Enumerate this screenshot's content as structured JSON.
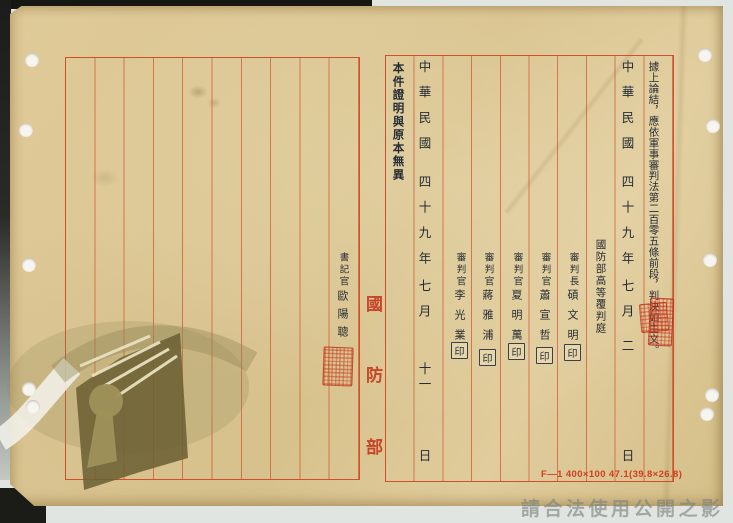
{
  "document": {
    "watermark_notice": "請合法使用公開之影像",
    "form_code": "F—1 400×100 47.1(39.8×26.8)",
    "fold_label": {
      "chars": [
        "國",
        "防",
        "部"
      ]
    },
    "right_page": {
      "verdict_line": "據上論結，應依軍事審判法第二百零五條前段，判決如主文。",
      "judgment_date": {
        "era": "中華民國",
        "year": "四十九年",
        "month": "七月",
        "day": "二",
        "day_suffix": "日"
      },
      "court": "國防部高等覆判庭",
      "officials": [
        {
          "role": "審判長",
          "name": "碩文明",
          "seal_glyph": "印"
        },
        {
          "role": "審判官",
          "name": "蕭宣哲",
          "seal_glyph": "印"
        },
        {
          "role": "審判官",
          "name": "夏明萬",
          "seal_glyph": "印"
        },
        {
          "role": "審判官",
          "name": "蔣雅浦",
          "seal_glyph": "印"
        },
        {
          "role": "審判官",
          "name": "李光業",
          "seal_glyph": "印"
        }
      ],
      "certification_statement": "本件證明與原本無異",
      "certification_date": {
        "era": "中華民國",
        "year": "四十九年",
        "month": "七月",
        "day": "十一",
        "day_suffix": "日"
      }
    },
    "left_page": {
      "clerk_role": "書記官",
      "clerk_name": "歐陽聰"
    },
    "icons": {
      "judgment_seal": "red-ink-seal",
      "clerk_seal": "red-ink-seal",
      "archives_emblem": "book-keyhole-watermark",
      "punch_hole": "binding-hole"
    },
    "colors": {
      "rule_red": "#cd4224",
      "seal_red": "#c5311d",
      "ink": "#242c35",
      "paper": "#dcc794",
      "fold_red": "#c43a1f",
      "scanner_gray": "#e1e5e2"
    }
  }
}
